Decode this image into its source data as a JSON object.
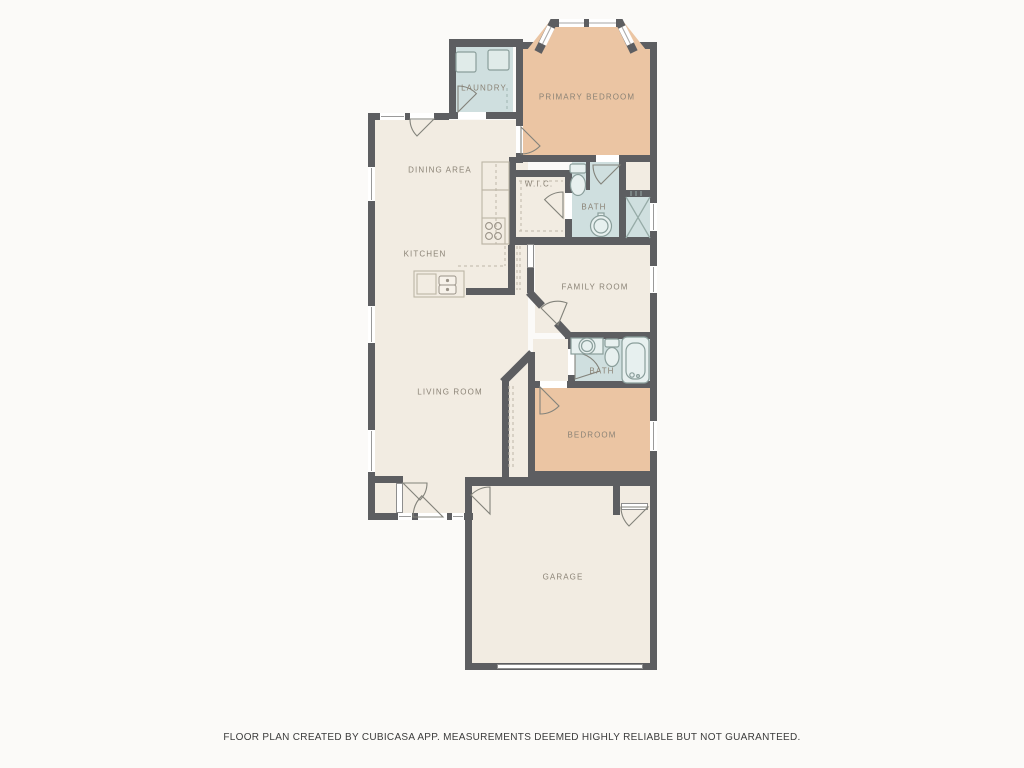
{
  "plan": {
    "rooms": [
      {
        "id": "laundry",
        "label": "LAUNDRY"
      },
      {
        "id": "primary-bedroom",
        "label": "PRIMARY BEDROOM"
      },
      {
        "id": "dining-area",
        "label": "DINING AREA"
      },
      {
        "id": "walk-in-closet",
        "label": "W.I.C."
      },
      {
        "id": "primary-bath",
        "label": "BATH"
      },
      {
        "id": "kitchen",
        "label": "KITCHEN"
      },
      {
        "id": "family-room",
        "label": "FAMILY ROOM"
      },
      {
        "id": "living-room",
        "label": "LIVING ROOM"
      },
      {
        "id": "bath-2",
        "label": "BATH"
      },
      {
        "id": "bedroom",
        "label": "BEDROOM"
      },
      {
        "id": "garage",
        "label": "GARAGE"
      }
    ],
    "footer": "FLOOR PLAN CREATED BY CUBICASA APP. MEASUREMENTS DEEMED HIGHLY RELIABLE BUT NOT GUARANTEED."
  },
  "colors": {
    "background": "#fbfaf8",
    "wall": "#5d5e61",
    "room_cream": "#f2ece2",
    "room_orange": "#ebc5a3",
    "room_wet": "#cfdfdf",
    "label": "#8b8376",
    "fixture": "#8a9e9b",
    "counter": "#bcb5a6"
  }
}
